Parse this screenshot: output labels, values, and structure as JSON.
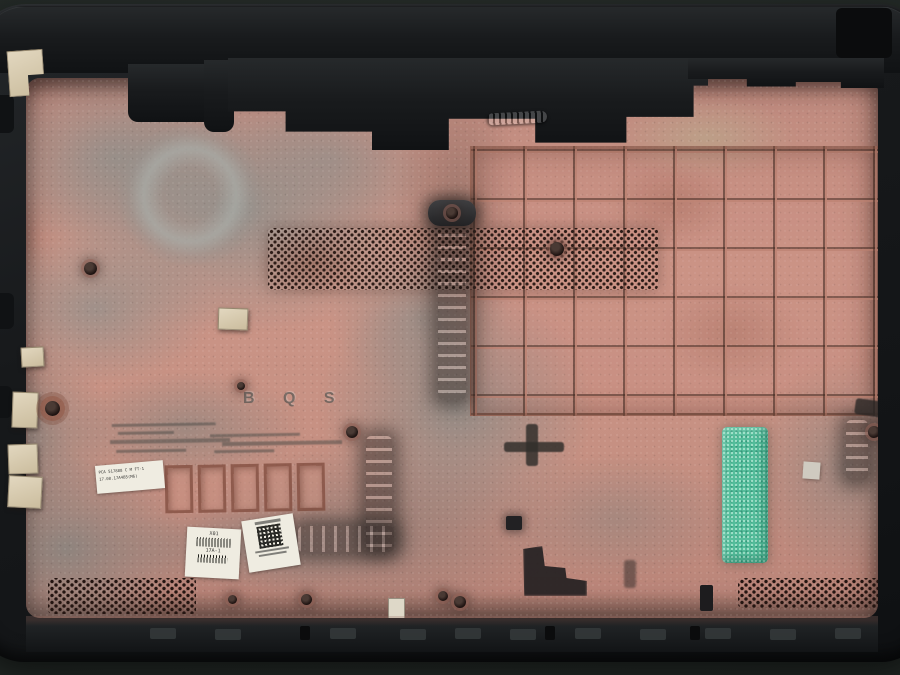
{
  "scene": {
    "type": "photograph",
    "subject": "laptop bottom case shell, interior facing up, coated in pink dust and gray soot",
    "colors": {
      "background": "#232825",
      "shell_black": "#17191b",
      "surface_pink": "#c69082",
      "soot_gray": "#8d8f8b",
      "foam_pad_green": "#55bd9b",
      "sticker_white": "#efece1",
      "vent_hole": "#2e1d18",
      "rib_line": "#7b5a4e",
      "bracket_cream": "#d6c9ad"
    }
  },
  "markings": {
    "embossed_code": "B Q S",
    "pca_label": {
      "line1": "PCA 517888 C M FT-1",
      "line2": "17.08.17A4B5(M6)"
    },
    "serial_label": {
      "top": "X01",
      "mid": "17A-1"
    }
  }
}
